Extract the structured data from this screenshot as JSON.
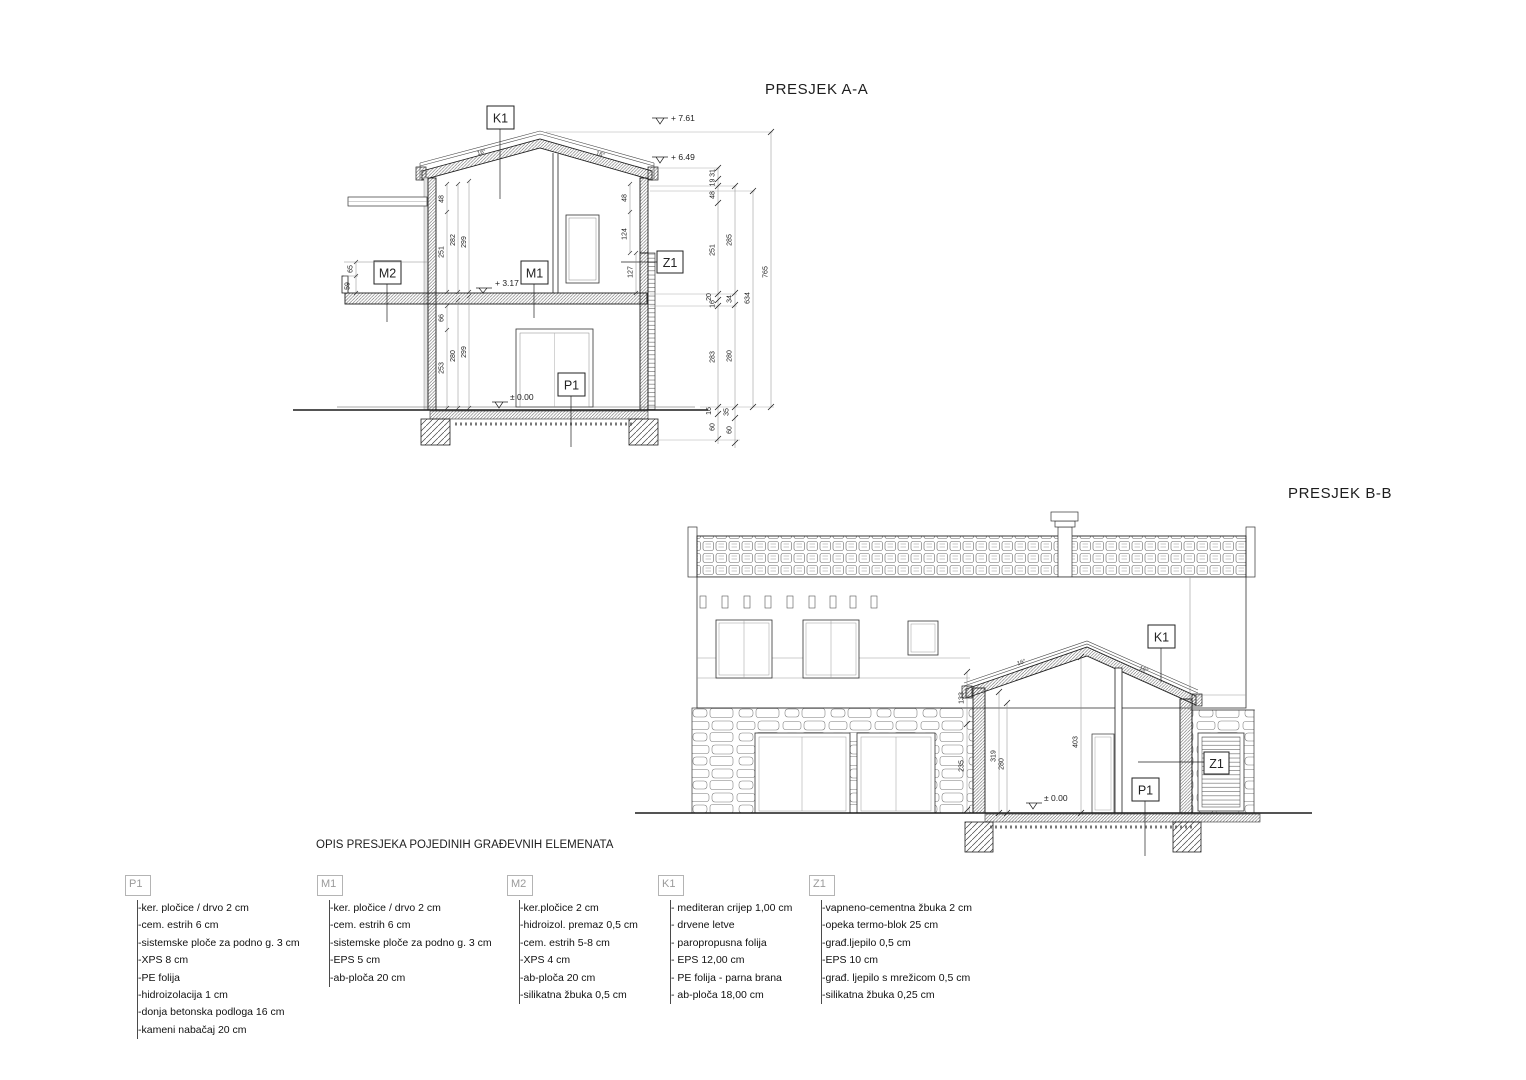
{
  "section_a": {
    "title": "PRESJEK A-A",
    "boxes": {
      "k1": "K1",
      "m1": "M1",
      "m2": "M2",
      "z1": "Z1",
      "p1": "P1"
    },
    "elev": {
      "ridge": "+ 7.61",
      "eave": "+ 6.49",
      "floor": "+ 3.17",
      "ground": "± 0.00"
    },
    "slope": {
      "left": "16°",
      "right": "16°"
    },
    "dims": {
      "il48": "48",
      "il251": "251",
      "il282": "282",
      "il299": "299",
      "b65": "65",
      "b59": "59",
      "ll66": "66",
      "ll253": "253",
      "ll280": "280",
      "ll299": "299",
      "ir48": "48",
      "ir124": "124",
      "ir127": "127",
      "c1_31": "31",
      "c1_19": "19",
      "c1_48": "48",
      "c1_251": "251",
      "c1_20": "20",
      "c1_16a": "16",
      "c1_283": "283",
      "c1_16b": "16",
      "c1_60": "60",
      "c2_285": "285",
      "c2_34": "34",
      "c2_280": "280",
      "c2_35": "35",
      "c2_60": "60",
      "c3_634": "634",
      "c4_765": "765"
    }
  },
  "section_b": {
    "title": "PRESJEK B-B",
    "boxes": {
      "k1": "K1",
      "z1": "Z1",
      "p1": "P1"
    },
    "elev": {
      "ground": "± 0.00"
    },
    "slope": {
      "left": "16°",
      "right": "16°"
    },
    "dims": {
      "h133": "133",
      "h235": "235",
      "h319": "319",
      "h280": "280",
      "h403": "403"
    }
  },
  "legend": {
    "title": "OPIS PRESJEKA POJEDINIH GRAĐEVNIH ELEMENATA",
    "columns": [
      {
        "id": "P1",
        "items": [
          "ker. pločice / drvo 2 cm",
          "cem. estrih  6 cm",
          "sistemske ploče za podno g. 3 cm",
          "XPS 8 cm",
          "PE folija",
          "hidroizolacija  1 cm",
          "donja betonska podloga 16 cm",
          "kameni nabačaj 20 cm"
        ]
      },
      {
        "id": "M1",
        "items": [
          "ker. pločice / drvo 2 cm",
          "cem. estrih 6 cm",
          "sistemske ploče za podno g. 3 cm",
          "EPS 5 cm",
          "ab-ploča 20 cm"
        ]
      },
      {
        "id": "M2",
        "items": [
          "ker.pločice 2 cm",
          "hidroizol. premaz 0,5 cm",
          "cem. estrih 5-8 cm",
          "XPS 4 cm",
          "ab-ploča 20 cm",
          "silikatna žbuka 0,5 cm"
        ]
      },
      {
        "id": "K1",
        "items": [
          " mediteran crijep 1,00 cm",
          " drvene letve",
          " paropropusna folija",
          " EPS  12,00 cm",
          " PE folija - parna brana",
          " ab-ploča 18,00 cm"
        ]
      },
      {
        "id": "Z1",
        "items": [
          "vapneno-cementna žbuka 2 cm",
          "opeka termo-blok 25 cm",
          "građ.ljepilo 0,5 cm",
          "EPS 10 cm",
          "građ. ljepilo s mrežicom 0,5 cm",
          "silikatna žbuka 0,25 cm"
        ]
      }
    ]
  }
}
